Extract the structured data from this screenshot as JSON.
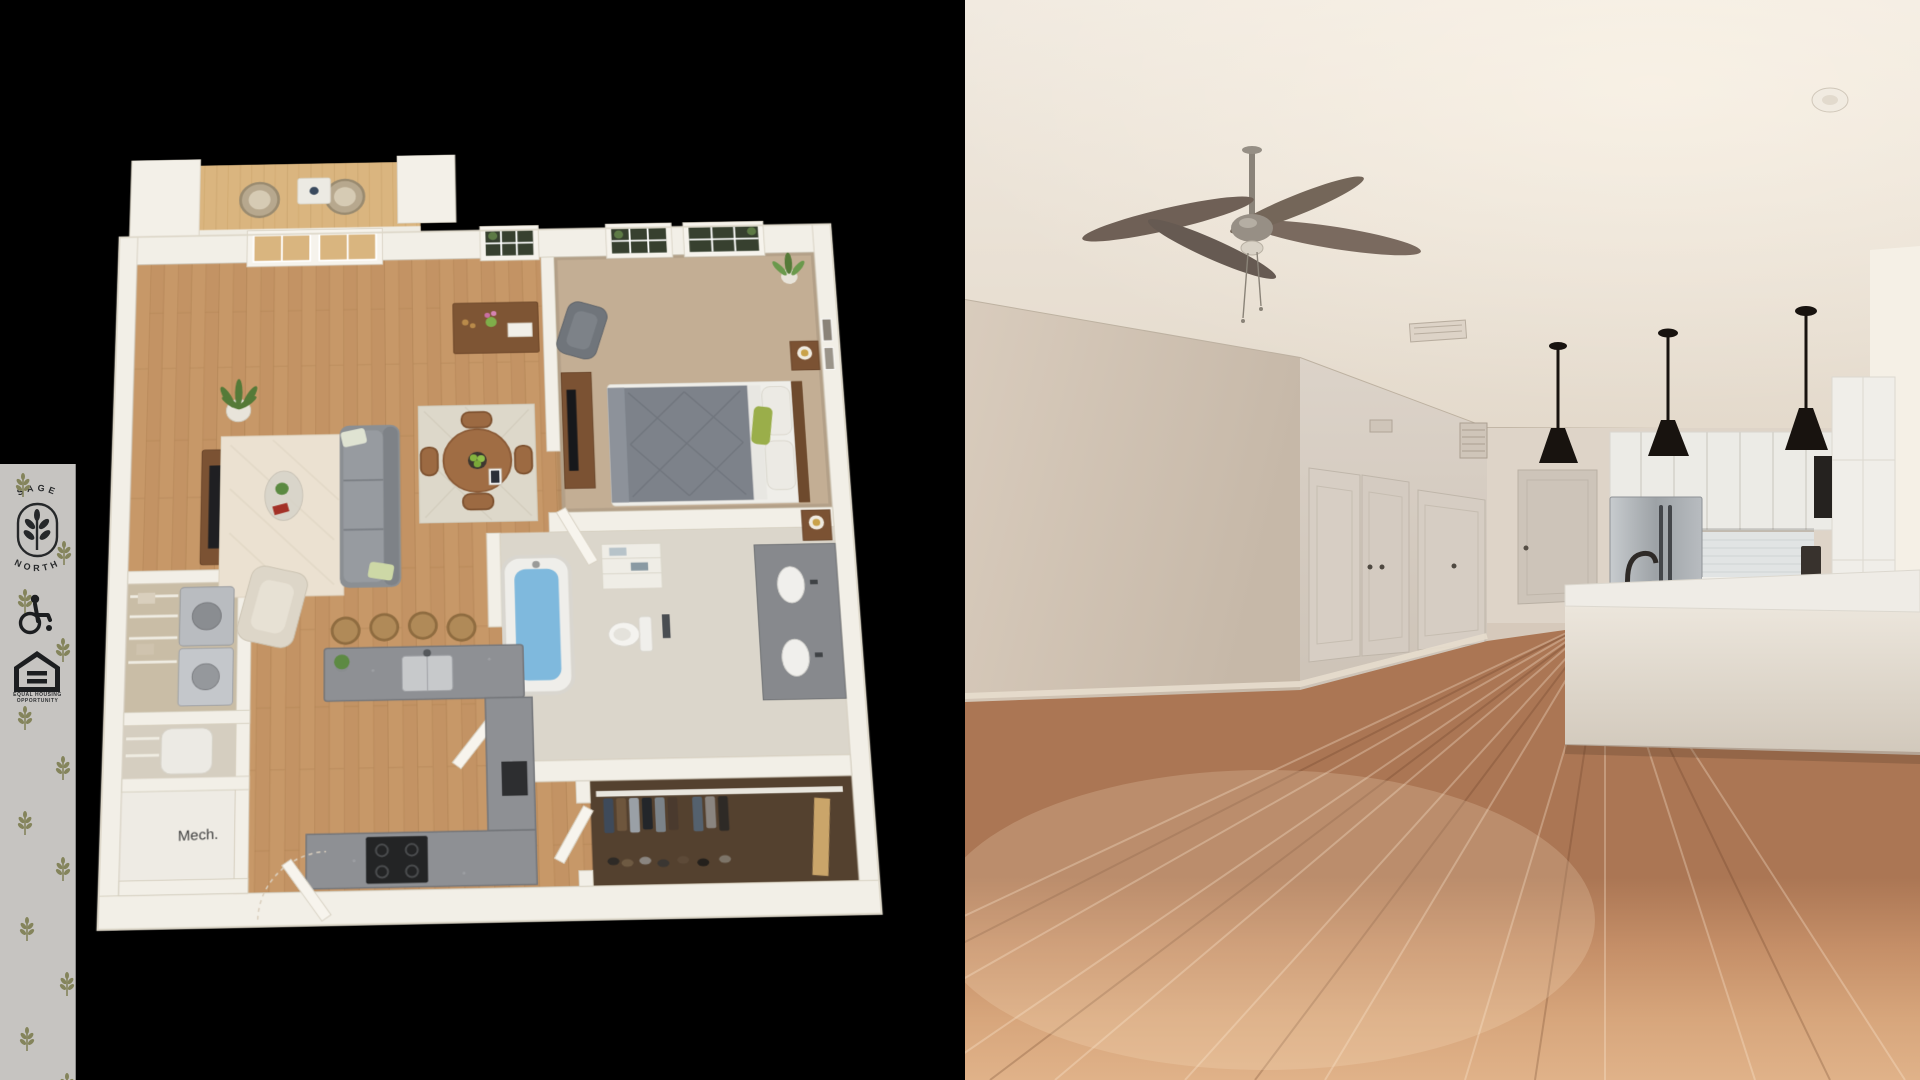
{
  "branding": {
    "name_top": "SAGE",
    "name_bottom": "NORTH",
    "equal_housing_line1": "EQUAL HOUSING",
    "equal_housing_line2": "OPPORTUNITY"
  },
  "floorplan": {
    "mech_label": "Mech."
  },
  "colors": {
    "background": "#000000",
    "sidebar_bg": "#c6c4c1",
    "logo_ink": "#26282a",
    "sprig_olive": "#84845b",
    "plan_wall": "#f2efe7",
    "plan_wood": "#c89a6a",
    "plan_carpet": "#c3ae94",
    "plan_granite": "#8e9094",
    "tub_water": "#7fb9dd",
    "photo_wall": "#d2c5b7",
    "photo_floor": "#cf9c77",
    "pendant_black": "#18130f",
    "fridge_steel": "#aab0b4"
  }
}
